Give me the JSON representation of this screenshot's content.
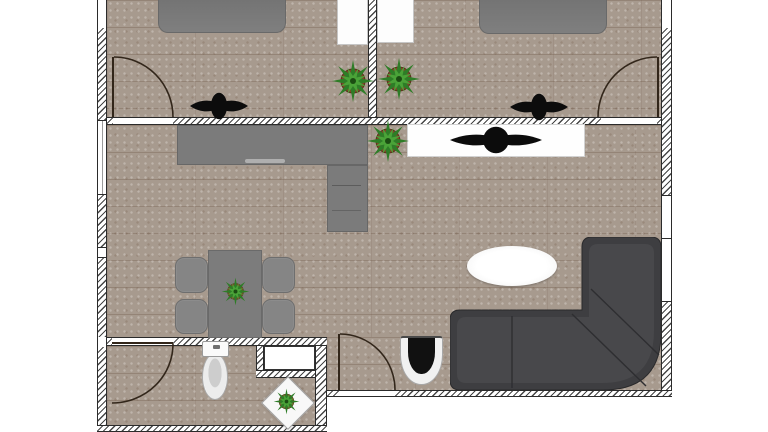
{
  "app": {
    "view": "floor-plan"
  },
  "colors": {
    "floor": "#a79a8e",
    "wall-line": "#454545",
    "wall-border": "#2b2b2b",
    "furn-gray": "#7b7b7b",
    "furn-gray-dark": "#696969",
    "sofa": "#3e3e41",
    "sofa-seat": "#48484b",
    "sofa-seam": "#2e2e31",
    "white-item": "#fdfdfd",
    "white-item-border": "#c6c6c6",
    "plant-green": "#2e7d27",
    "plant-green-light": "#4aa338",
    "plant-pot": "#7c4a28",
    "symbol-black": "#0c0c0c",
    "door": "#32261a"
  },
  "icons": [
    "potted-plant-icon",
    "tv-icon",
    "door-swing-arc",
    "window-symbol",
    "toilet-symbol",
    "corner-sofa",
    "coffee-table",
    "dining-set"
  ],
  "scene": {
    "rooms": [
      "bedroom-1",
      "bedroom-2",
      "living-room-kitchen",
      "bathroom"
    ],
    "items": [
      {
        "id": "f-bed1",
        "name": "bedroom-1-floor",
        "x": 107,
        "y": 0,
        "w": 261,
        "h": 117
      },
      {
        "id": "f-bed2",
        "name": "bedroom-2-floor",
        "x": 377,
        "y": 0,
        "w": 284,
        "h": 117
      },
      {
        "id": "f-liv-a",
        "name": "living-room-floor",
        "x": 107,
        "y": 125,
        "w": 554,
        "h": 212
      },
      {
        "id": "f-liv-b",
        "name": "living-room-floor-lower",
        "x": 327,
        "y": 337,
        "w": 334,
        "h": 53
      },
      {
        "id": "f-bath",
        "name": "bathroom-floor",
        "x": 107,
        "y": 346,
        "w": 208,
        "h": 79
      },
      {
        "id": "wl-top",
        "name": "left-wall-top",
        "x": 97,
        "y": 0,
        "w": 10,
        "h": 28
      },
      {
        "id": "wl-h1",
        "name": "left-wall",
        "x": 97,
        "y": 28,
        "w": 10,
        "h": 92
      },
      {
        "id": "wl-win1",
        "name": "left-window-1",
        "x": 97,
        "y": 120,
        "w": 10,
        "h": 75
      },
      {
        "id": "wl-h2",
        "name": "left-wall",
        "x": 97,
        "y": 195,
        "w": 10,
        "h": 52
      },
      {
        "id": "wl-win2",
        "name": "left-window-2",
        "x": 97,
        "y": 247,
        "w": 10,
        "h": 11
      },
      {
        "id": "wl-h3",
        "name": "left-wall",
        "x": 97,
        "y": 258,
        "w": 10,
        "h": 79
      },
      {
        "id": "wl-j2",
        "name": "left-wall-junction",
        "x": 97,
        "y": 337,
        "w": 10,
        "h": 10
      },
      {
        "id": "wl-h4",
        "name": "left-wall",
        "x": 97,
        "y": 347,
        "w": 10,
        "h": 85
      },
      {
        "id": "wr-top",
        "name": "right-wall-top",
        "x": 661,
        "y": 0,
        "w": 11,
        "h": 28
      },
      {
        "id": "wr-h1",
        "name": "right-wall",
        "x": 661,
        "y": 28,
        "w": 11,
        "h": 167
      },
      {
        "id": "wr-win",
        "name": "right-window",
        "x": 661,
        "y": 195,
        "w": 11,
        "h": 107
      },
      {
        "id": "wr-h2",
        "name": "right-wall",
        "x": 661,
        "y": 302,
        "w": 11,
        "h": 95
      },
      {
        "id": "dv",
        "name": "bedroom-divider-wall",
        "x": 368,
        "y": 0,
        "w": 9,
        "h": 125
      },
      {
        "id": "dh-a",
        "name": "bedroom-living-wall",
        "x": 107,
        "y": 117,
        "w": 6,
        "h": 8
      },
      {
        "id": "dh-t1",
        "name": "bedroom-1-door-threshold",
        "x": 113,
        "y": 117,
        "w": 60,
        "h": 8
      },
      {
        "id": "dh-b",
        "name": "bedroom-living-wall",
        "x": 173,
        "y": 117,
        "w": 428,
        "h": 8
      },
      {
        "id": "dh-t2",
        "name": "bedroom-2-door-threshold",
        "x": 601,
        "y": 117,
        "w": 56,
        "h": 8
      },
      {
        "id": "dh-c",
        "name": "bedroom-living-wall",
        "x": 657,
        "y": 117,
        "w": 4,
        "h": 8
      },
      {
        "id": "bt-a",
        "name": "bathroom-wall",
        "x": 107,
        "y": 337,
        "w": 5,
        "h": 9
      },
      {
        "id": "bt-t",
        "name": "bathroom-door-threshold",
        "x": 112,
        "y": 337,
        "w": 61,
        "h": 9
      },
      {
        "id": "bt-b",
        "name": "bathroom-wall",
        "x": 173,
        "y": 337,
        "w": 154,
        "h": 9
      },
      {
        "id": "niche-stub",
        "name": "niche-wall-stub",
        "x": 256,
        "y": 346,
        "w": 8,
        "h": 24
      },
      {
        "id": "niche-band",
        "name": "niche-wall-band",
        "x": 256,
        "y": 370,
        "w": 66,
        "h": 8
      },
      {
        "id": "niche-box",
        "name": "wall-niche-cabinet",
        "x": 264,
        "y": 346,
        "w": 51,
        "h": 24
      },
      {
        "id": "br",
        "name": "bathroom-right-wall",
        "x": 315,
        "y": 346,
        "w": 12,
        "h": 86
      },
      {
        "id": "bb",
        "name": "bathroom-bottom-wall",
        "x": 97,
        "y": 425,
        "w": 230,
        "h": 7
      },
      {
        "id": "lb-a",
        "name": "bottom-wall",
        "x": 327,
        "y": 390,
        "w": 12,
        "h": 7
      },
      {
        "id": "lb-t",
        "name": "entrance-threshold",
        "x": 339,
        "y": 390,
        "w": 56,
        "h": 7
      },
      {
        "id": "lb-b",
        "name": "bottom-wall",
        "x": 395,
        "y": 390,
        "w": 277,
        "h": 7
      },
      {
        "id": "leaf-bed1",
        "name": "bedroom-1-door-leaf",
        "x": 112,
        "y": 57,
        "w": 2,
        "h": 60
      },
      {
        "id": "arc-bed1",
        "name": "bedroom-1-door-arc",
        "x": 114,
        "y": 57,
        "w": 59,
        "h": 60
      },
      {
        "id": "leaf-bed2",
        "name": "bedroom-2-door-leaf",
        "x": 657,
        "y": 57,
        "w": 2,
        "h": 60
      },
      {
        "id": "arc-bed2",
        "name": "bedroom-2-door-arc",
        "x": 598,
        "y": 57,
        "w": 59,
        "h": 60
      },
      {
        "id": "leaf-ent",
        "name": "entrance-door-leaf",
        "x": 338,
        "y": 334,
        "w": 2,
        "h": 56
      },
      {
        "id": "arc-ent",
        "name": "entrance-door-arc",
        "x": 340,
        "y": 334,
        "w": 55,
        "h": 56
      },
      {
        "id": "leaf-bath",
        "name": "bathroom-door-leaf",
        "x": 112,
        "y": 342,
        "w": 61,
        "h": 2
      },
      {
        "id": "arc-bath",
        "name": "bathroom-door-arc",
        "x": 112,
        "y": 344,
        "w": 61,
        "h": 59
      },
      {
        "id": "bed1",
        "name": "double-bed-1",
        "x": 158,
        "y": 0,
        "w": 128,
        "h": 33
      },
      {
        "id": "bed2",
        "name": "double-bed-2",
        "x": 479,
        "y": 0,
        "w": 128,
        "h": 34
      },
      {
        "id": "wardrobe1",
        "name": "wardrobe-1",
        "x": 337,
        "y": 0,
        "w": 31,
        "h": 45
      },
      {
        "id": "wardrobe2",
        "name": "wardrobe-2",
        "x": 377,
        "y": 0,
        "w": 37,
        "h": 43
      },
      {
        "id": "counter-h",
        "name": "kitchen-counter",
        "x": 177,
        "y": 125,
        "w": 191,
        "h": 40
      },
      {
        "id": "counter-v",
        "name": "kitchen-counter-leg",
        "x": 327,
        "y": 165,
        "w": 41,
        "h": 67
      },
      {
        "id": "sideboard",
        "name": "tv-sideboard",
        "x": 407,
        "y": 124,
        "w": 178,
        "h": 33
      },
      {
        "id": "tv1",
        "name": "tv-bedroom-1",
        "x": 190,
        "y": 92,
        "w": 58,
        "h": 28
      },
      {
        "id": "tv2",
        "name": "tv-bedroom-2",
        "x": 510,
        "y": 93,
        "w": 58,
        "h": 28
      },
      {
        "id": "tv3",
        "name": "tv-living-room",
        "x": 450,
        "y": 126,
        "w": 92,
        "h": 28
      },
      {
        "id": "plant-bed1",
        "name": "potted-plant",
        "x": 331,
        "y": 59,
        "w": 44,
        "h": 44
      },
      {
        "id": "plant-bed2",
        "name": "potted-plant",
        "x": 377,
        "y": 57,
        "w": 44,
        "h": 44
      },
      {
        "id": "plant-living",
        "name": "potted-plant",
        "x": 366,
        "y": 119,
        "w": 44,
        "h": 44
      },
      {
        "id": "plant-table",
        "name": "table-plant",
        "x": 221,
        "y": 277,
        "w": 29,
        "h": 29
      },
      {
        "id": "plant-diamond",
        "name": "stand-plant",
        "x": 273,
        "y": 388,
        "w": 27,
        "h": 27
      },
      {
        "id": "table",
        "name": "dining-table",
        "x": 208,
        "y": 250,
        "w": 54,
        "h": 88
      },
      {
        "id": "chair-tl",
        "name": "dining-chair",
        "x": 175,
        "y": 257,
        "w": 33,
        "h": 36
      },
      {
        "id": "chair-bl",
        "name": "dining-chair",
        "x": 175,
        "y": 299,
        "w": 33,
        "h": 35
      },
      {
        "id": "chair-tr",
        "name": "dining-chair",
        "x": 262,
        "y": 257,
        "w": 33,
        "h": 36
      },
      {
        "id": "chair-br",
        "name": "dining-chair",
        "x": 262,
        "y": 299,
        "w": 33,
        "h": 35
      },
      {
        "id": "toilet-tank",
        "name": "toilet-tank",
        "x": 202,
        "y": 341,
        "w": 27,
        "h": 16
      },
      {
        "id": "toilet-bowl",
        "name": "toilet-bowl",
        "x": 202,
        "y": 353,
        "w": 26,
        "h": 47
      },
      {
        "id": "accent-chair",
        "name": "accent-chair",
        "x": 400,
        "y": 336,
        "w": 43,
        "h": 49
      },
      {
        "id": "coffee-table",
        "name": "oval-coffee-table",
        "x": 467,
        "y": 246,
        "w": 90,
        "h": 40
      },
      {
        "id": "diamond-table",
        "name": "diamond-plant-stand",
        "x": 269,
        "y": 384,
        "w": 38,
        "h": 38
      },
      {
        "id": "sofa",
        "name": "corner-sofa",
        "x": 450,
        "y": 237,
        "w": 211,
        "h": 153
      }
    ]
  }
}
